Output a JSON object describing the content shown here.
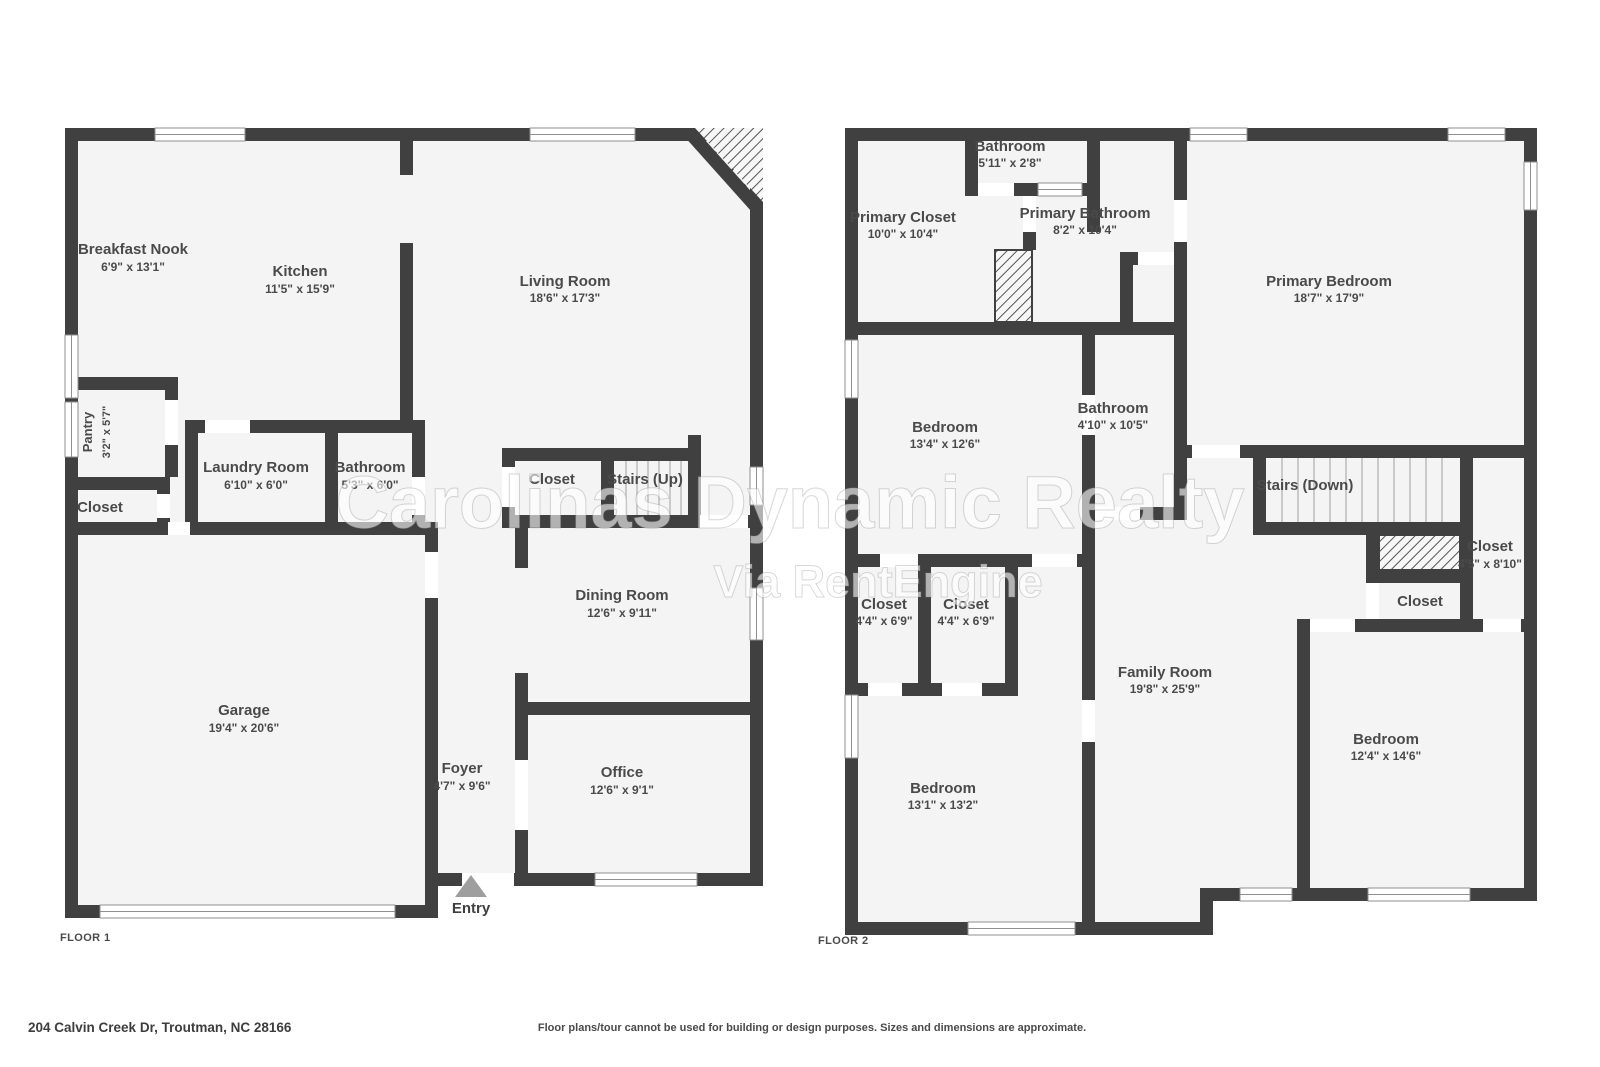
{
  "colors": {
    "wall": "#404040",
    "floor_fill": "#f4f4f4",
    "label_text": "#4a4a4a",
    "background": "#ffffff",
    "window_frame": "#8f8f8f"
  },
  "watermark": {
    "line1": "Carolinas Dynamic Realty",
    "line2": "Via RentEngine"
  },
  "footer": {
    "address": "204 Calvin Creek Dr, Troutman, NC 28166",
    "disclaimer": "Floor plans/tour cannot be used for building or design purposes. Sizes and dimensions are approximate."
  },
  "floor1": {
    "label": "FLOOR 1",
    "entry": "Entry",
    "fireplace": "Fireplace",
    "rooms": {
      "breakfast_nook": {
        "name": "Breakfast Nook",
        "dims": "6'9\" x 13'1\""
      },
      "kitchen": {
        "name": "Kitchen",
        "dims": "11'5\" x 15'9\""
      },
      "living_room": {
        "name": "Living Room",
        "dims": "18'6\" x 17'3\""
      },
      "pantry": {
        "name": "Pantry",
        "dims": "3'2\" x 5'7\""
      },
      "closet_left": {
        "name": "Closet"
      },
      "laundry": {
        "name": "Laundry Room",
        "dims": "6'10\" x 6'0\""
      },
      "bathroom": {
        "name": "Bathroom",
        "dims": "5'3\" x 6'0\""
      },
      "closet_mid": {
        "name": "Closet"
      },
      "stairs_up": {
        "name": "Stairs (Up)"
      },
      "dining": {
        "name": "Dining Room",
        "dims": "12'6\" x 9'11\""
      },
      "garage": {
        "name": "Garage",
        "dims": "19'4\" x 20'6\""
      },
      "foyer": {
        "name": "Foyer",
        "dims": "4'7\" x 9'6\""
      },
      "office": {
        "name": "Office",
        "dims": "12'6\" x 9'1\""
      }
    }
  },
  "floor2": {
    "label": "FLOOR 2",
    "rooms": {
      "bathroom_top": {
        "name": "Bathroom",
        "dims": "5'11\" x 2'8\""
      },
      "primary_closet": {
        "name": "Primary Closet",
        "dims": "10'0\" x 10'4\""
      },
      "primary_bathroom": {
        "name": "Primary Bathroom",
        "dims": "8'2\" x 10'4\""
      },
      "primary_bedroom": {
        "name": "Primary Bedroom",
        "dims": "18'7\" x 17'9\""
      },
      "bedroom_a": {
        "name": "Bedroom",
        "dims": "13'4\" x 12'6\""
      },
      "bathroom_mid": {
        "name": "Bathroom",
        "dims": "4'10\" x 10'5\""
      },
      "stairs_down": {
        "name": "Stairs (Down)"
      },
      "closet_right": {
        "name": "Closet",
        "dims": "4'5\" x 8'10\""
      },
      "closet_small": {
        "name": "Closet"
      },
      "closet_a": {
        "name": "Closet",
        "dims": "4'4\" x 6'9\""
      },
      "closet_b": {
        "name": "Closet",
        "dims": "4'4\" x 6'9\""
      },
      "family_room": {
        "name": "Family Room",
        "dims": "19'8\" x 25'9\""
      },
      "bedroom_b": {
        "name": "Bedroom",
        "dims": "13'1\" x 13'2\""
      },
      "bedroom_c": {
        "name": "Bedroom",
        "dims": "12'4\" x 14'6\""
      }
    }
  }
}
